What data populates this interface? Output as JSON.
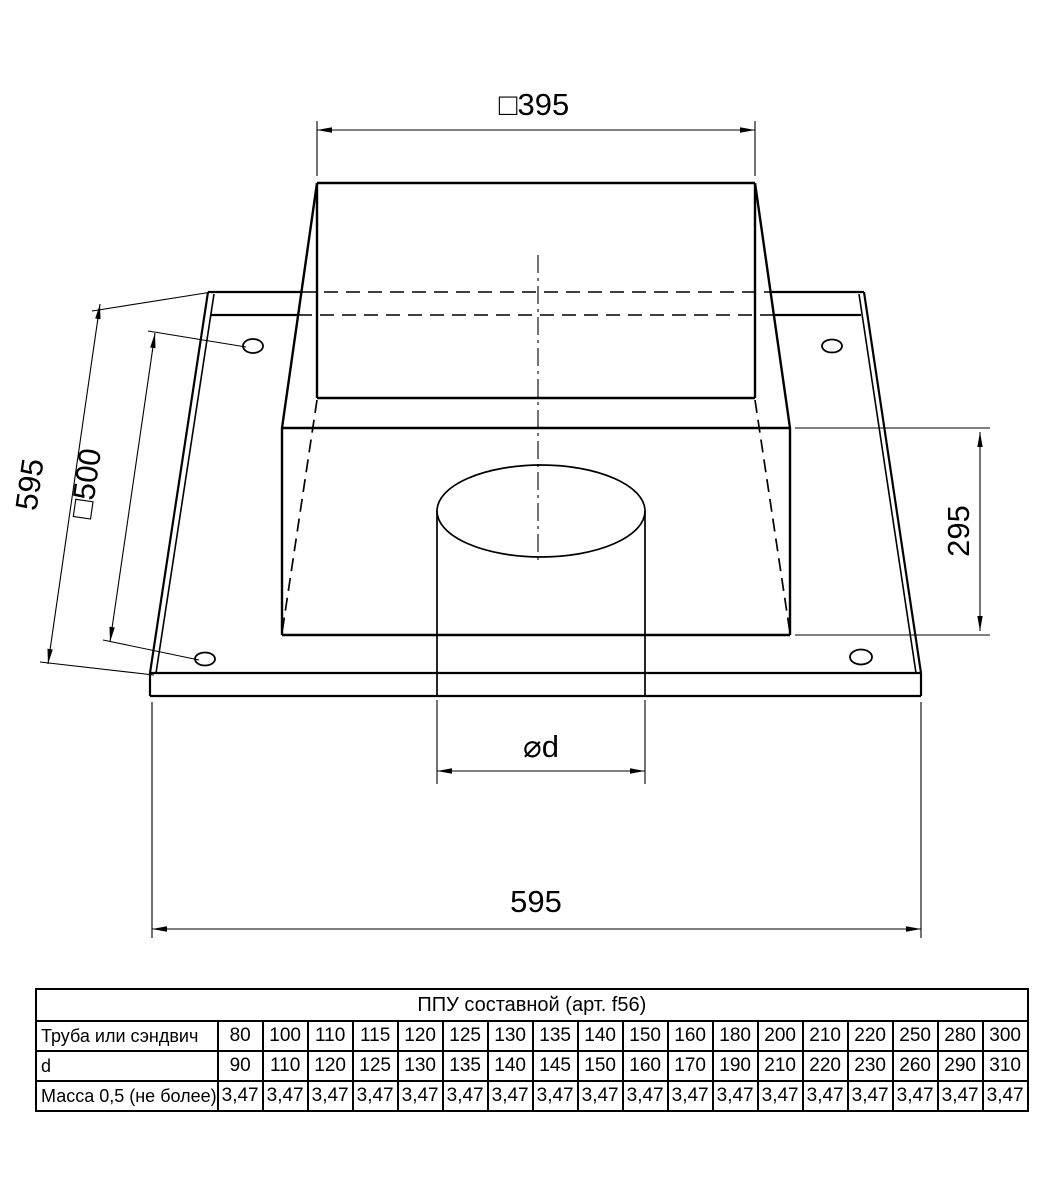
{
  "drawing": {
    "dimensions": {
      "duct_width": "□395",
      "plate_side": "595",
      "hole_spacing": "□500",
      "box_height": "295",
      "pipe_hole": "⌀d",
      "plate_width": "595"
    }
  },
  "table": {
    "title": "ППУ составной (арт. f56)",
    "rows": [
      {
        "label": "Труба или сэндвич",
        "values": [
          "80",
          "100",
          "110",
          "115",
          "120",
          "125",
          "130",
          "135",
          "140",
          "150",
          "160",
          "180",
          "200",
          "210",
          "220",
          "250",
          "280",
          "300"
        ]
      },
      {
        "label": "d",
        "values": [
          "90",
          "110",
          "120",
          "125",
          "130",
          "135",
          "140",
          "145",
          "150",
          "160",
          "170",
          "190",
          "210",
          "220",
          "230",
          "260",
          "290",
          "310"
        ]
      },
      {
        "label": "Масса 0,5 (не более)",
        "values": [
          "3,47",
          "3,47",
          "3,47",
          "3,47",
          "3,47",
          "3,47",
          "3,47",
          "3,47",
          "3,47",
          "3,47",
          "3,47",
          "3,47",
          "3,47",
          "3,47",
          "3,47",
          "3,47",
          "3,47",
          "3,47"
        ]
      }
    ]
  }
}
